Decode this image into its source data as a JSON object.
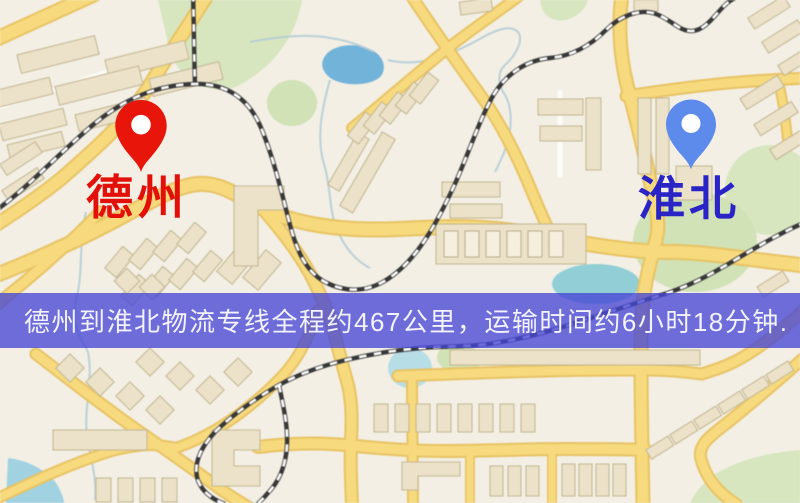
{
  "route_map": {
    "origin": {
      "label": "德州"
    },
    "destination": {
      "label": "淮北"
    },
    "banner": {
      "text": "德州到淮北物流专线全程约467公里，运输时间约6小时18分钟."
    },
    "colors": {
      "origin_pin": "#e8150b",
      "origin_label": "#e21009",
      "destination_pin": "#5d8bec",
      "destination_label": "#2a24c6",
      "banner_bg": "rgba(70,70,214,0.78)",
      "banner_text": "#f3f2ff",
      "road": "#f8da78",
      "railway": "#383838",
      "water": "#6fb4dd",
      "park": "#d7e6bd",
      "building": "#ece2c8",
      "map_background": "#f3efe4"
    }
  }
}
